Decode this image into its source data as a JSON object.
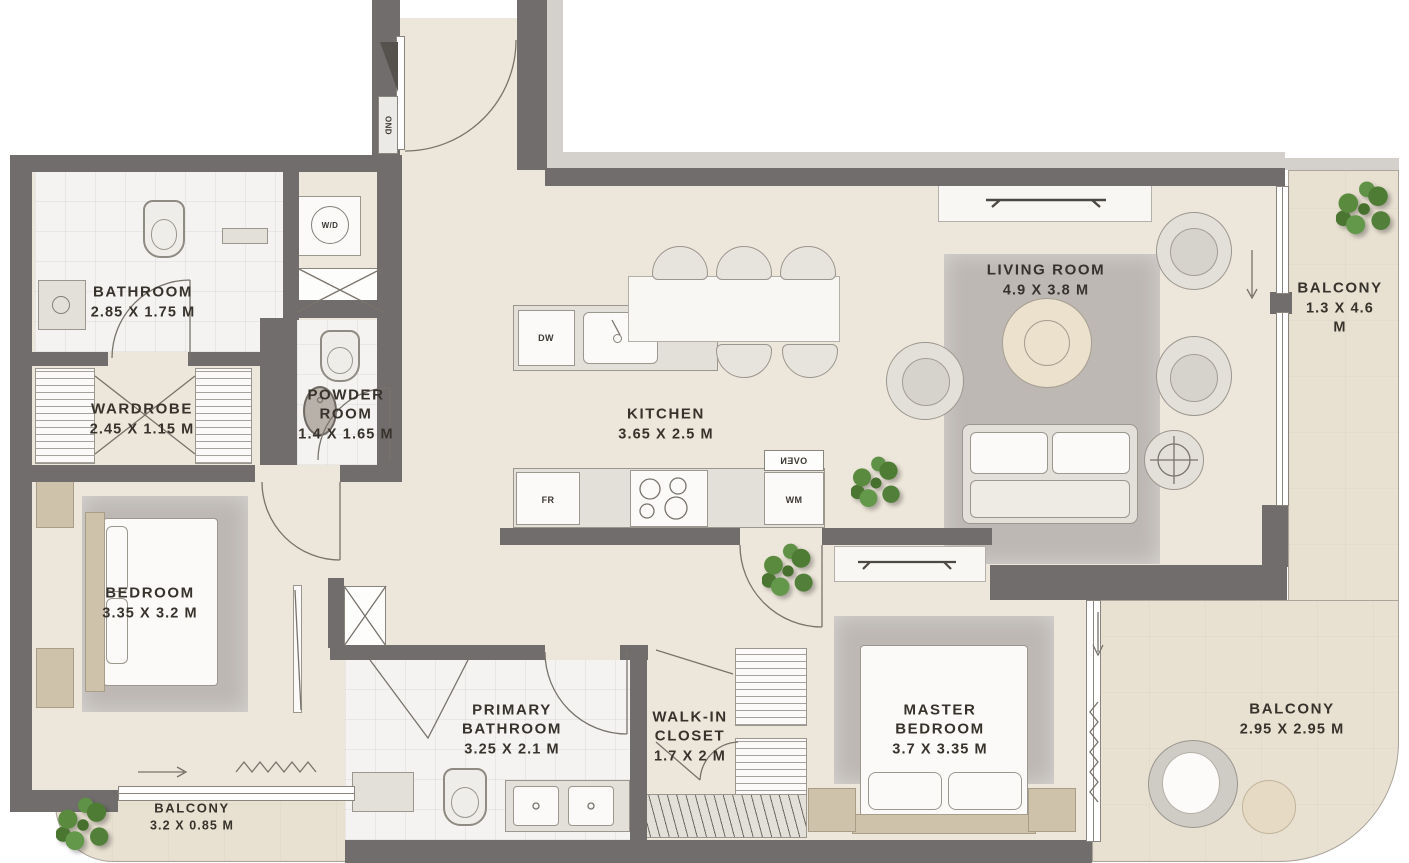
{
  "title": "2 Bedroom Apartment Floor Plan",
  "colors": {
    "wall": "#716d6c",
    "floor": "#ede6da",
    "balcony_floor": "#e8e0d1",
    "tile": "#f4f3f1",
    "rug": "#bdb8b4",
    "furniture": "#e3e0da",
    "marble": "#f8f7f4",
    "wood": "#cfc2aa",
    "plant": "#55813c",
    "text": "#37322b"
  },
  "rooms": [
    {
      "id": "bathroom",
      "name": "BATHROOM",
      "dims": "2.85 X 1.75 M"
    },
    {
      "id": "wardrobe",
      "name": "WARDROBE",
      "dims": "2.45 X 1.15 M"
    },
    {
      "id": "powder-room",
      "name": "POWDER\nROOM",
      "dims": "1.4 X 1.65 M"
    },
    {
      "id": "kitchen",
      "name": "KITCHEN",
      "dims": "3.65 X 2.5 M"
    },
    {
      "id": "living-room",
      "name": "LIVING ROOM",
      "dims": "4.9 X 3.8 M"
    },
    {
      "id": "balcony-right",
      "name": "BALCONY",
      "dims": "1.3 X 4.6 M"
    },
    {
      "id": "bedroom",
      "name": "BEDROOM",
      "dims": "3.35 X 3.2 M"
    },
    {
      "id": "balcony-bottom-left",
      "name": "BALCONY",
      "dims": "3.2 X 0.85 M"
    },
    {
      "id": "primary-bathroom",
      "name": "PRIMARY\nBATHROOM",
      "dims": "3.25 X 2.1 M"
    },
    {
      "id": "walk-in-closet",
      "name": "WALK-IN\nCLOSET",
      "dims": "1.7 X 2 M"
    },
    {
      "id": "master-bedroom",
      "name": "MASTER\nBEDROOM",
      "dims": "3.7 X 3.35 M"
    },
    {
      "id": "balcony-bottom-right",
      "name": "BALCONY",
      "dims": "2.95 X 2.95 M"
    }
  ],
  "appliances": {
    "washer_dryer": "W/D",
    "dishwasher": "DW",
    "fridge": "FR",
    "washing_machine": "WM",
    "oven": "OVEN",
    "duct": "OND"
  }
}
